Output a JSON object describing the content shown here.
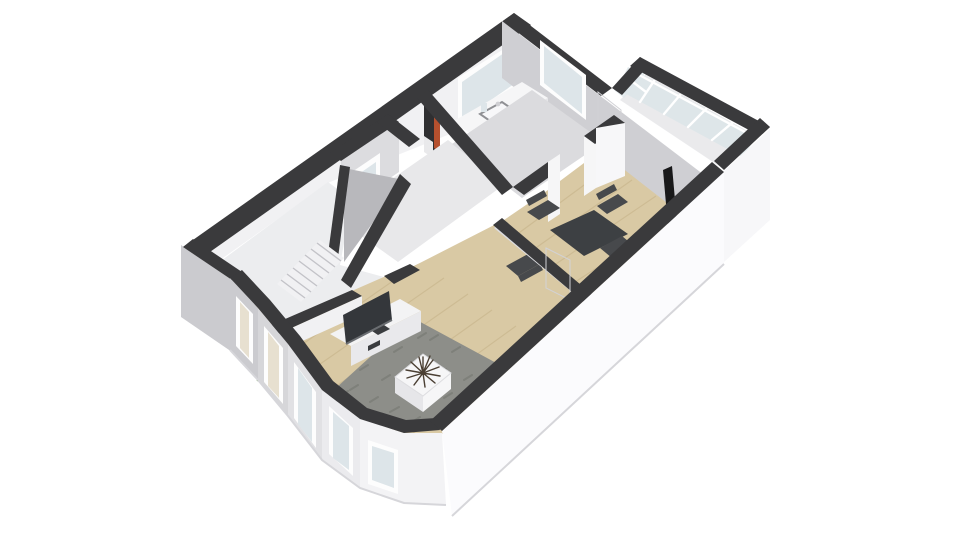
{
  "scene": {
    "kind": "3d-floor-plan-rendering",
    "view": "isometric dollhouse cutaway, single storey",
    "rooms": [
      "hallway-with-staircase",
      "storage-room",
      "bathroom",
      "corridor",
      "living-room",
      "dining-room",
      "conservatory",
      "bay-window-nook"
    ],
    "furniture": [
      "flat-screen-tv",
      "tv-stand",
      "floor-plant",
      "area-rug",
      "coffee-table-with-twig-plant",
      "dining-table",
      "dining-chair",
      "dining-chair",
      "dining-chair",
      "dining-chair",
      "kitchen-sink-counter",
      "bookshelf",
      "stove-flue-pipe",
      "interior-doors",
      "windows"
    ]
  },
  "colors": {
    "pageBg": "#ffffff",
    "band": "#3a3a3c",
    "bandSoft": "#46464a",
    "wallBright": "#f1f1f3",
    "wallWhite": "#f7f7f9",
    "wallMid": "#dcdcdf",
    "wallShade": "#cfcfd3",
    "wallDark": "#b9b9bd",
    "faceOuterA": "#cbcbcf",
    "faceOuterB": "#d6d6d9",
    "faceOuterC": "#e1e1e4",
    "faceOuterD": "#ebebee",
    "faceOuterE": "#f3f3f5",
    "faceBig": "#fbfbfd",
    "floorHall": "#ecedef",
    "floorCorridor": "#e8e8ea",
    "floorBath": "#dbdbde",
    "floorWood": "#d9c9a4",
    "plank": "#c2ae85",
    "conservatoryFloor": "#eaeaec",
    "glass": "#dde5e9",
    "glassWarm": "#e7e0d0",
    "frameWhite": "#fdfdfd",
    "rug": "#8d8e89",
    "rugDark": "#75766f",
    "whiteFurni": "#f6f6f7",
    "whiteFurniSide": "#e6e6e9",
    "tvPanel": "#34373b",
    "tvEdge": "#6a6d71",
    "stand": "#f3f3f4",
    "standFront": "#e9e9ec",
    "slotDark": "#3a3c3f",
    "tableDark": "#3d4043",
    "chairDark": "#47494c",
    "flue": "#19191a",
    "shelfDark": "#2f2f31",
    "books": "#b5502e",
    "drawerWhite": "#e9e9eb",
    "green": "#5f9147",
    "greenDark": "#49742f",
    "twigs": "#4a3f33",
    "doorWhite": "#fafafa",
    "stairFill": "#f1f1f3",
    "wedgeGrey": "#b8b8bc"
  }
}
